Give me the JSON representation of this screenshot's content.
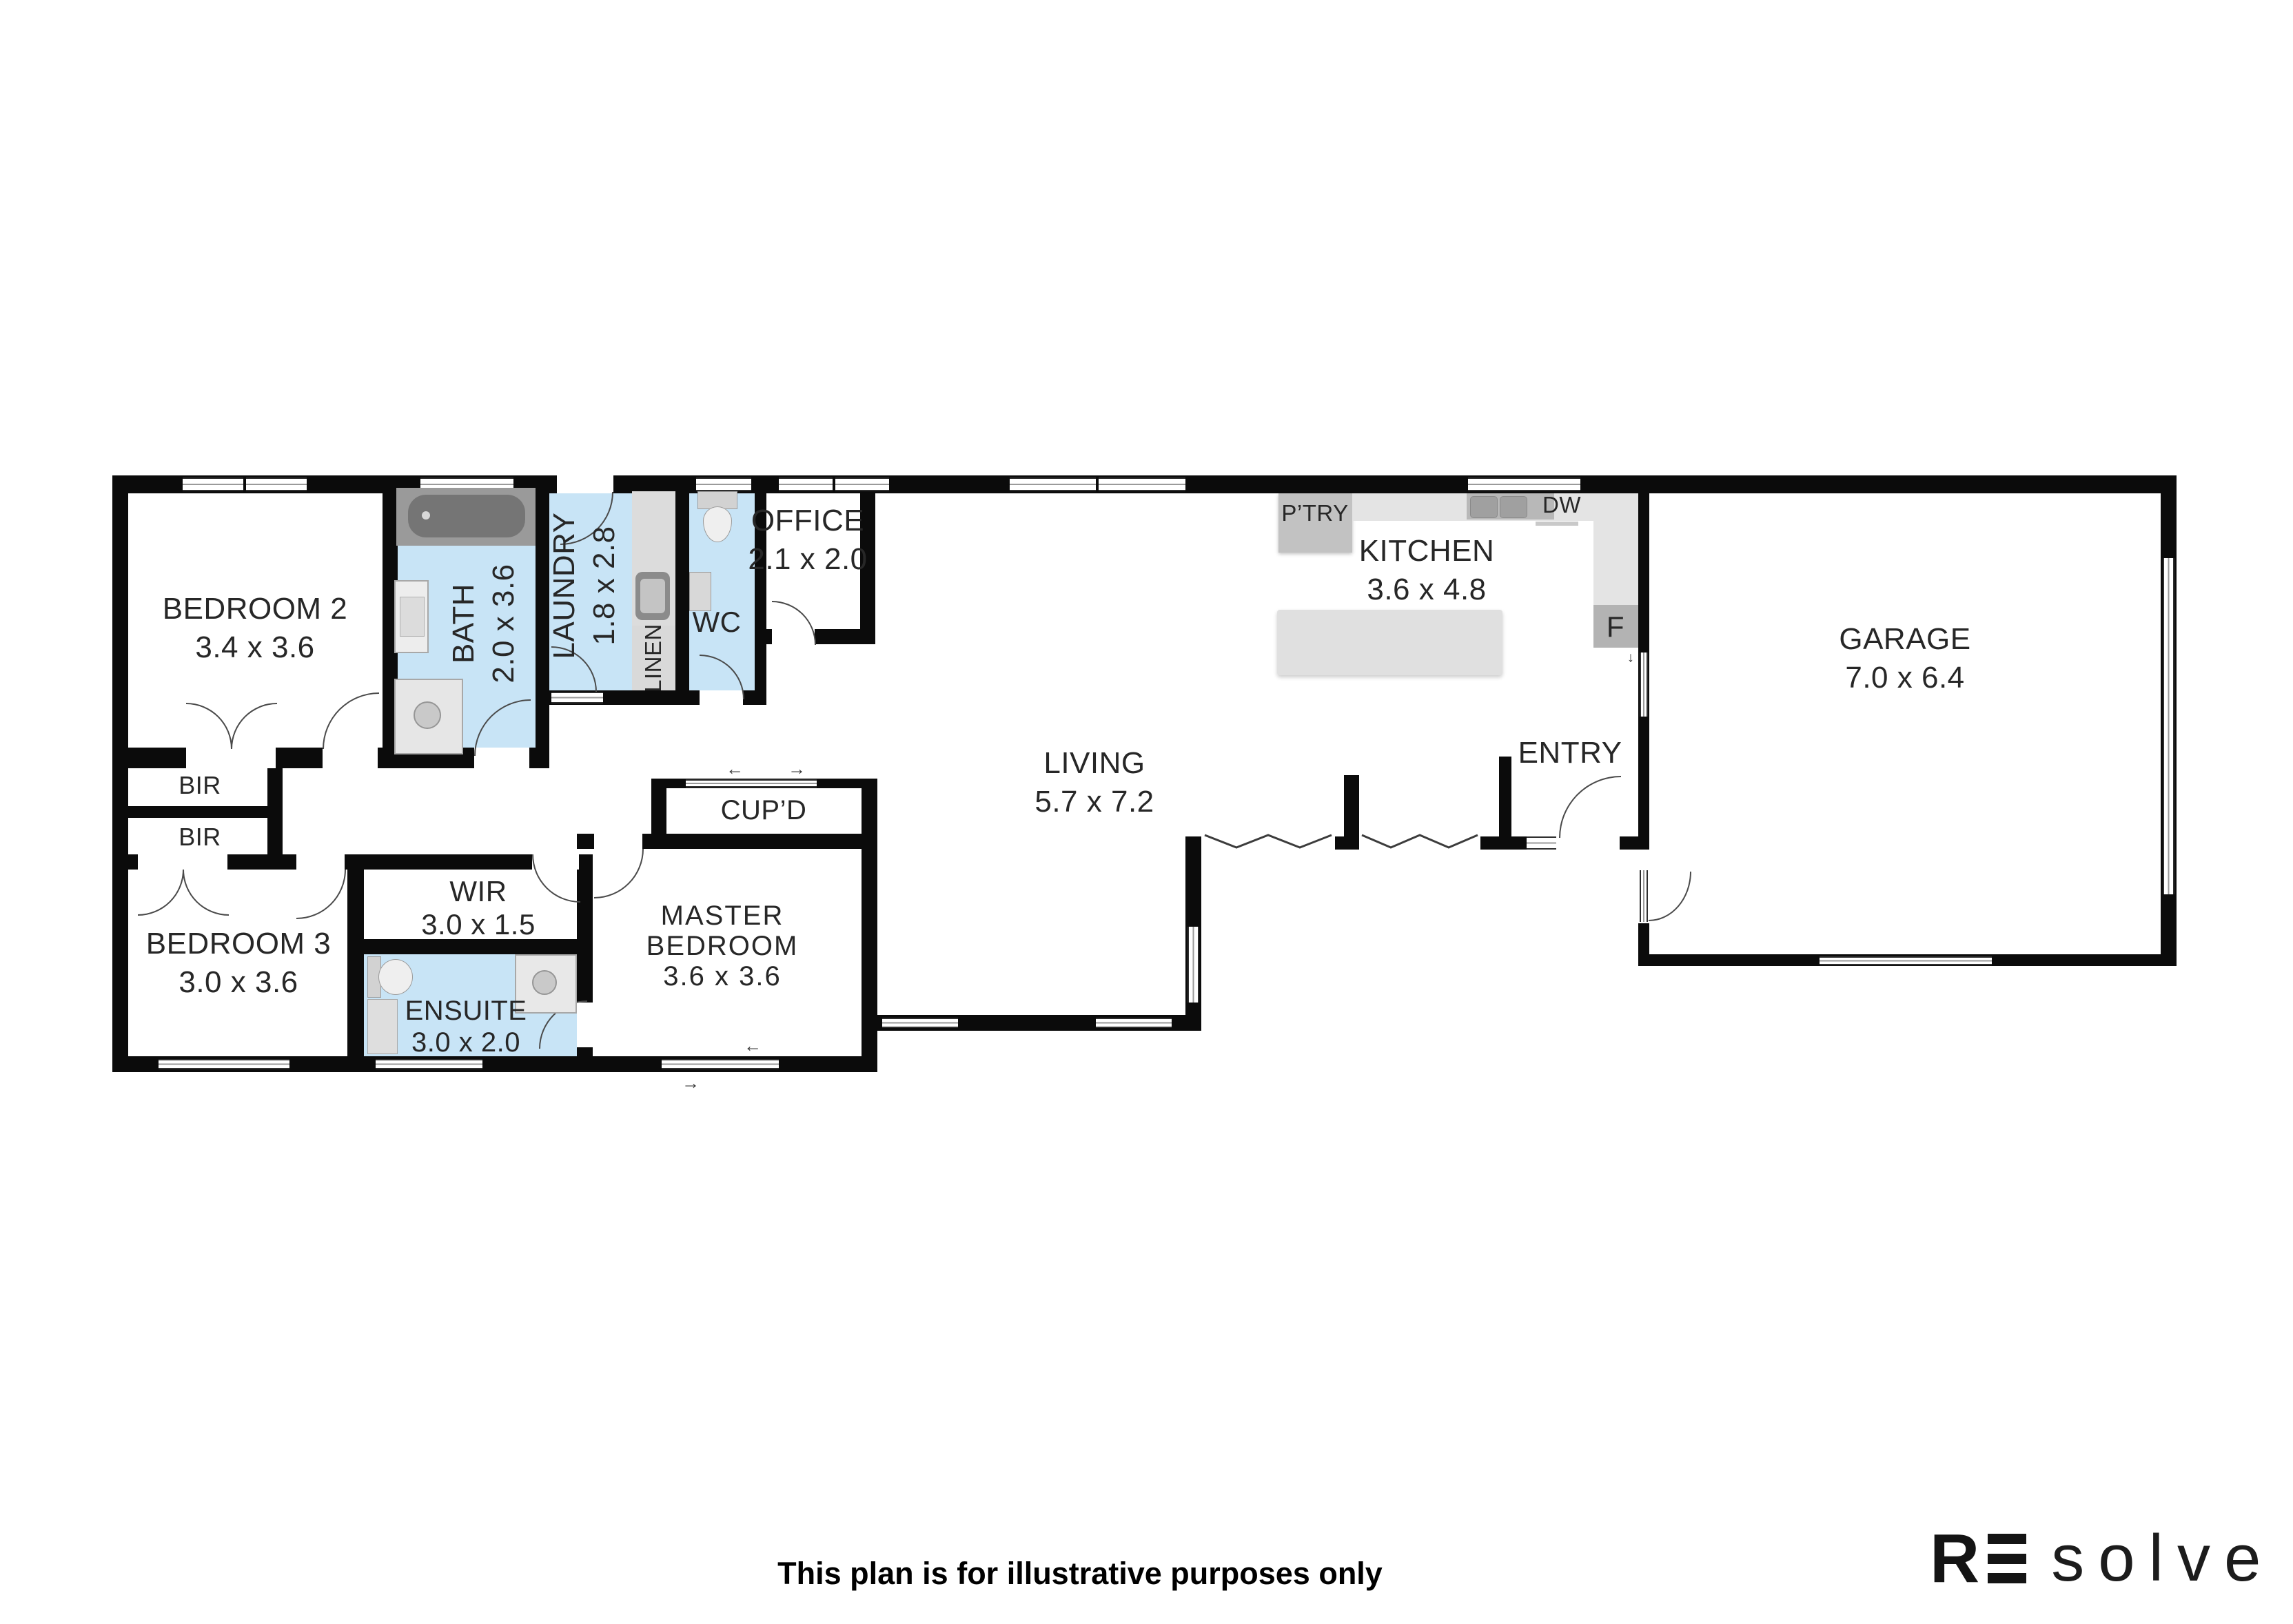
{
  "rooms": {
    "bedroom2": {
      "name": "BEDROOM 2",
      "dims": "3.4 x 3.6"
    },
    "bath": {
      "name": "BATH",
      "dims": "2.0 x 3.6"
    },
    "laundry": {
      "name": "LAUNDRY",
      "dims": "1.8 x 2.8"
    },
    "linen": {
      "name": "LINEN"
    },
    "wc": {
      "name": "WC"
    },
    "office": {
      "name": "OFFICE",
      "dims": "2.1 x 2.0"
    },
    "kitchen": {
      "name": "KITCHEN",
      "dims": "3.6 x 4.8"
    },
    "pantry": {
      "name": "P’TRY"
    },
    "dishwasher": {
      "name": "DW"
    },
    "fridge": {
      "name": "F"
    },
    "living": {
      "name": "LIVING",
      "dims": "5.7 x 7.2"
    },
    "entry": {
      "name": "ENTRY"
    },
    "garage": {
      "name": "GARAGE",
      "dims": "7.0 x 6.4"
    },
    "bir1": {
      "name": "BIR"
    },
    "bir2": {
      "name": "BIR"
    },
    "bedroom3": {
      "name": "BEDROOM 3",
      "dims": "3.0 x 3.6"
    },
    "wir": {
      "name": "WIR",
      "dims": "3.0 x 1.5"
    },
    "ensuite": {
      "name": "ENSUITE",
      "dims": "3.0 x 2.0"
    },
    "cupd": {
      "name": "CUP’D"
    },
    "master": {
      "line1": "MASTER",
      "line2": "BEDROOM",
      "dims": "3.6 x 3.6"
    }
  },
  "icons": {
    "arrow_left": "←",
    "arrow_right": "→",
    "arrow_down": "↓"
  },
  "colors": {
    "wall": "#0b0b0b",
    "wet_area": "#c8e4f6",
    "fixture": "#e2e2e2",
    "label": "#272727"
  },
  "footer": {
    "disclaimer": "This plan is for illustrative purposes only"
  },
  "logo": {
    "r": "R",
    "solve": "solve"
  }
}
